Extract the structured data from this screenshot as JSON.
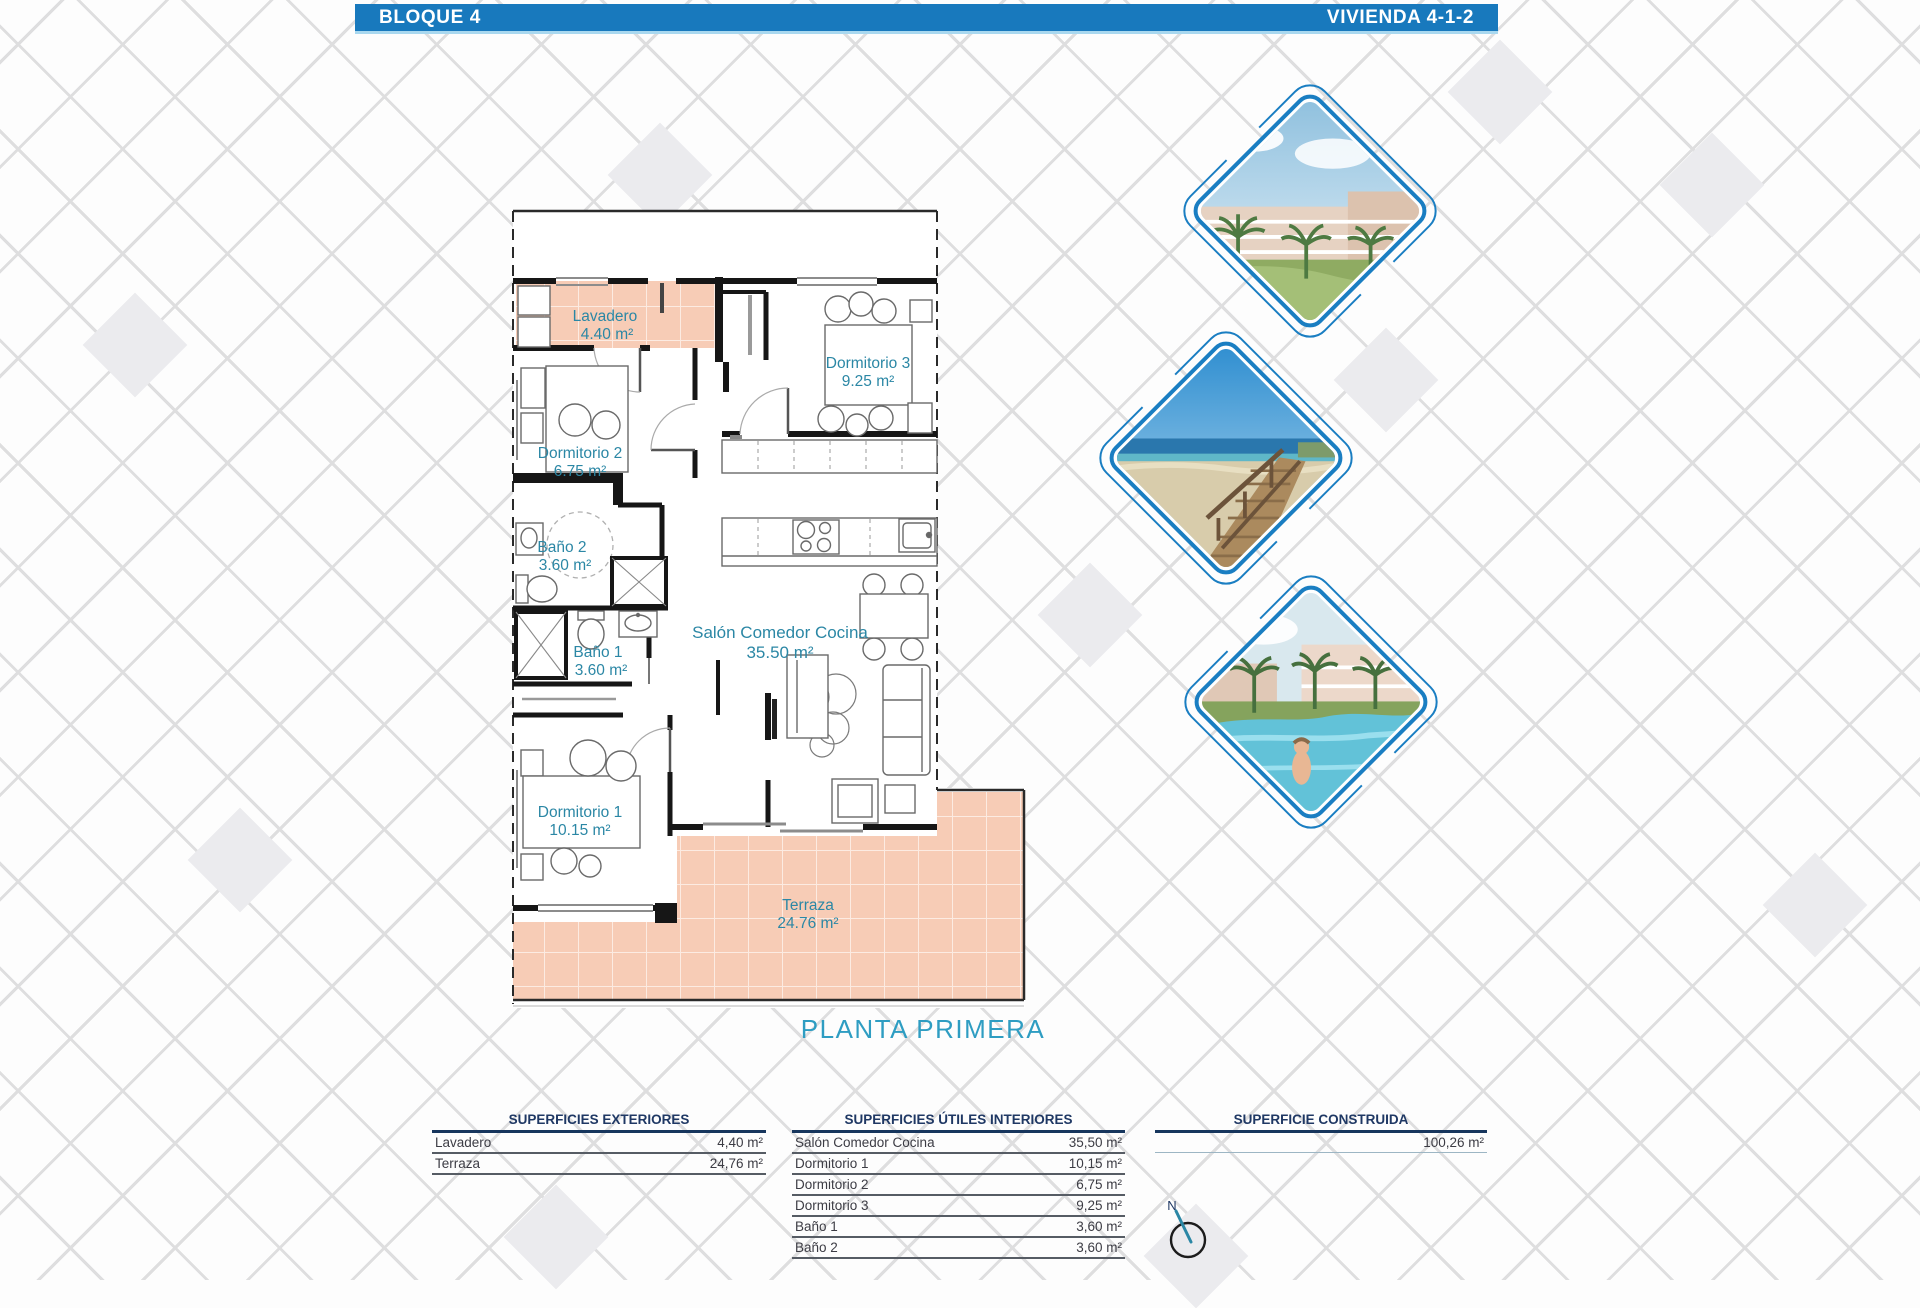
{
  "header": {
    "left_title": "BLOQUE 4",
    "right_title": "VIVIENDA 4-1-2"
  },
  "plan": {
    "floor_label": "PLANTA PRIMERA",
    "compass_label": "N",
    "rooms": [
      {
        "name": "Lavadero",
        "area": "4.40 m²"
      },
      {
        "name": "Dormitorio 3",
        "area": "9.25 m²"
      },
      {
        "name": "Dormitorio 2",
        "area": "6.75 m²"
      },
      {
        "name": "Baño 2",
        "area": "3.60 m²"
      },
      {
        "name": "Baño 1",
        "area": "3.60 m²"
      },
      {
        "name": "Salón Comedor Cocina",
        "area": "35.50 m²"
      },
      {
        "name": "Dormitorio 1",
        "area": "10.15 m²"
      },
      {
        "name": "Terraza",
        "area": "24.76 m²"
      }
    ]
  },
  "tables": {
    "exteriores": {
      "title": "SUPERFICIES EXTERIORES",
      "rows": [
        {
          "label": "Lavadero",
          "value": "4,40 m²"
        },
        {
          "label": "Terraza",
          "value": "24,76 m²"
        }
      ]
    },
    "interiores": {
      "title": "SUPERFICIES ÚTILES INTERIORES",
      "rows": [
        {
          "label": "Salón Comedor Cocina",
          "value": "35,50 m²"
        },
        {
          "label": "Dormitorio 1",
          "value": "10,15 m²"
        },
        {
          "label": "Dormitorio 2",
          "value": "6,75 m²"
        },
        {
          "label": "Dormitorio 3",
          "value": "9,25 m²"
        },
        {
          "label": "Baño 1",
          "value": "3,60 m²"
        },
        {
          "label": "Baño 2",
          "value": "3,60 m²"
        }
      ]
    },
    "construida": {
      "title": "SUPERFICIE CONSTRUIDA",
      "value": "100,26 m²"
    }
  },
  "photos": [
    {
      "name": "apartment-render"
    },
    {
      "name": "beach-boardwalk"
    },
    {
      "name": "pool-render"
    }
  ],
  "colors": {
    "header_blue": "#1879bd",
    "label_teal": "#2b87a5",
    "floor_label_teal": "#2e9dc2",
    "peach_fill": "#f7ccb6",
    "frame_blue": "#1a7ec2",
    "table_navy": "#1f3864"
  }
}
